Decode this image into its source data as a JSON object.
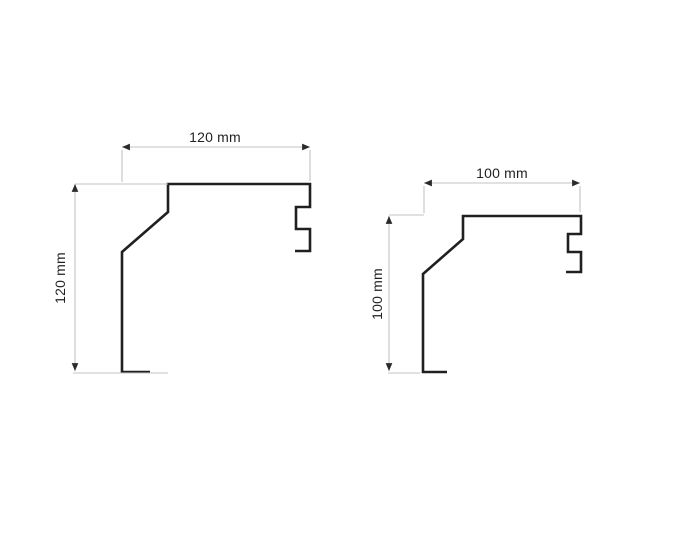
{
  "colors": {
    "background": "#ffffff",
    "profile-stroke": "#231f20",
    "dim-line": "#c3c3c3",
    "arrow": "#2d2a2b",
    "label-text": "#231f20"
  },
  "profiles": {
    "left": {
      "width_label": "120 mm",
      "height_label": "120 mm",
      "width_mm": 120,
      "height_mm": 120,
      "outline_points": "150,372 122,372 122,252 168,212 168,184 310,184 310,207 296,207 296,229 310,229 310,251 295,251"
    },
    "right": {
      "width_label": "100 mm",
      "height_label": "100 mm",
      "width_mm": 100,
      "height_mm": 100,
      "outline_points": "447,372 423,372 423,274 463,239 463,216 581,216 581,234 568,234 568,252 581,252 581,272 566,272"
    }
  }
}
